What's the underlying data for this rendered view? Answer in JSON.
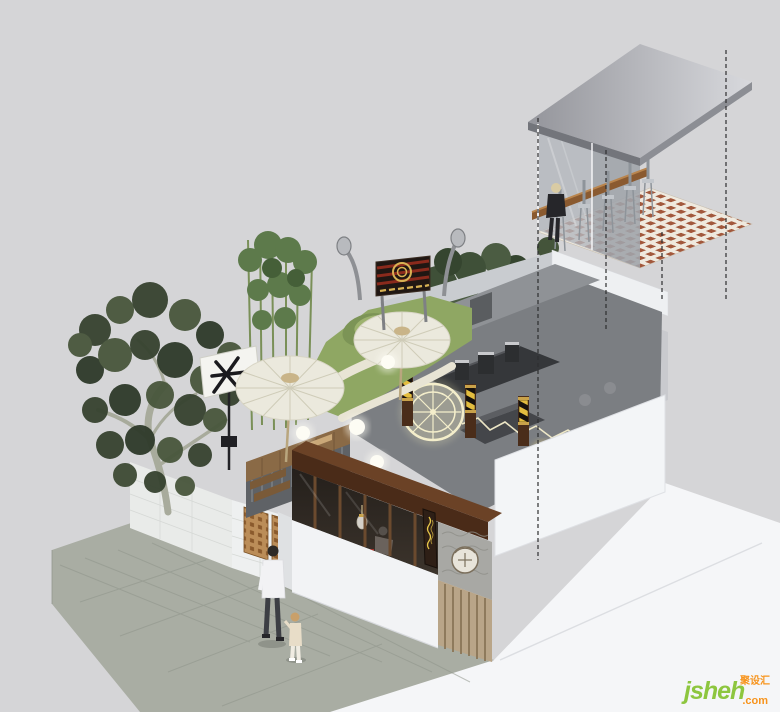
{
  "meta": {
    "title": "Axonometric architectural render - corner cafe / barbershop with rooftop tea garden and floating glass mezzanine",
    "canvas": {
      "width": 780,
      "height": 712
    },
    "background_color": "#d5d5d7"
  },
  "watermark": {
    "brand": "jsheh",
    "suffix": ".com",
    "cjk": "聚设汇",
    "brand_color": "#8dc63f",
    "accent_color": "#f7941d"
  },
  "palette": {
    "background": "#d5d5d7",
    "podium_white": "#f5f6f8",
    "pavement_gray": "#a9ada3",
    "wood_dark": "#4a2b18",
    "wood_mid": "#8a5a30",
    "lawn_green": "#8fa763",
    "foliage_dark": "#3f5038",
    "bamboo_green": "#5d7a4b",
    "umbrella_cream": "#ebe9dd",
    "neon_cream": "#f4eecb",
    "gold": "#d8b254",
    "medallion_gold": "#ead879",
    "glass_gray": "#b3b7bd",
    "roof_metal": "#b0b1b7",
    "mosaic_red": "#a2583c",
    "barber_yellow": "#e3bd3f",
    "dash_black": "#2e2e30"
  },
  "scene": {
    "style": "isometric cutaway exterior render with dashed projection lines",
    "elements": [
      {
        "name": "ground-podium",
        "description": "white display base with faint diagonal seam"
      },
      {
        "name": "stone-pavement",
        "description": "gray flagstone sidewalk along street corner"
      },
      {
        "name": "tiled-garden-wall",
        "description": "low white tiled wall with wooden lattice screens"
      },
      {
        "name": "old-tree",
        "description": "large pale-trunk tree with dark foliage"
      },
      {
        "name": "bamboo-grove",
        "description": "tall bamboo cluster on roof garden"
      },
      {
        "name": "flag-banner",
        "description": "white shop banner with black brush glyph on black pole"
      },
      {
        "name": "rooftop-lawn",
        "description": "green lawn with curved cream paths and moss mound"
      },
      {
        "name": "paper-umbrellas",
        "description": "two cream oil-paper umbrellas over the tea garden"
      },
      {
        "name": "globe-lamps",
        "description": "glowing white sphere landscape lamps"
      },
      {
        "name": "signboard",
        "description": "red and black striped signboard with gold emblem between two street lamps"
      },
      {
        "name": "interior-bar",
        "description": "open-top gray interior with coffee bar equipment"
      },
      {
        "name": "neon-wheel-sign",
        "description": "glowing cream neon wheel with spokes and zigzag neon line"
      },
      {
        "name": "barber-poles",
        "description": "black and yellow striped poles on dark wood columns"
      },
      {
        "name": "gold-medallion",
        "description": "large gold circular relief half-hidden behind gray wall"
      },
      {
        "name": "glass-mezzanine",
        "description": "floating glass box with wooden bar counter, tall stools and a seated guest"
      },
      {
        "name": "mezzanine-roof",
        "description": "gray sheet-metal mono roof"
      },
      {
        "name": "mosaic-floor",
        "description": "white terrazzo floor with red-brown square mosaic grid"
      },
      {
        "name": "projection-dashlines",
        "description": "black dashed vertical projection lines"
      },
      {
        "name": "storefront",
        "description": "white storefront with dark wood fascia, glazed window band, carved relief door and vertical script sign"
      },
      {
        "name": "pedestrians",
        "description": "adult in white jacket walking with small child on sidewalk"
      }
    ]
  }
}
